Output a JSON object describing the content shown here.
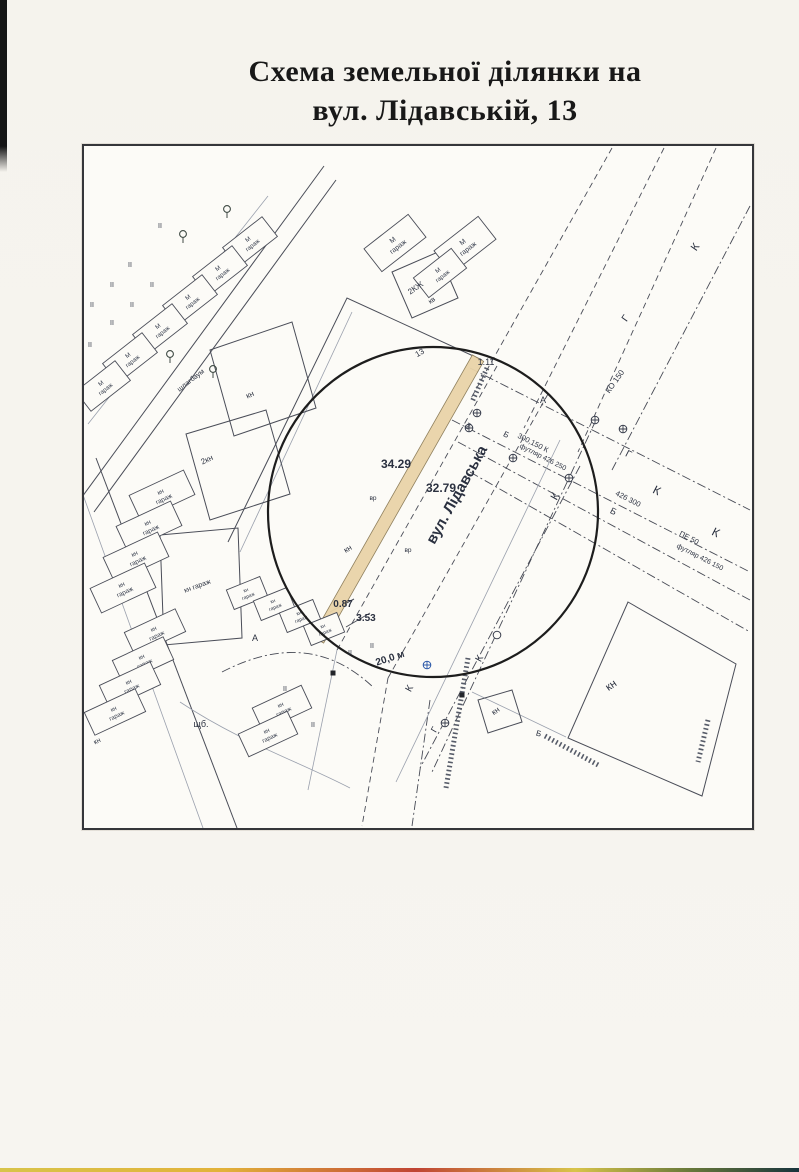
{
  "title": {
    "line1": "Схема земельної ділянки на",
    "line2": "вул. Лідавській, 13"
  },
  "map": {
    "garage_label": "гараж",
    "highlight_fill": "#ead4a9",
    "circle": {
      "cx": 433,
      "cy": 512,
      "r": 165
    },
    "strip": {
      "cx": 398,
      "cy": 499,
      "w": 13,
      "len": 324,
      "r": 29.6
    },
    "lines": [
      {
        "d": "M88,424 L268,196",
        "k": "light"
      },
      {
        "d": "M82,497 L324,166",
        "k": "solid"
      },
      {
        "d": "M94,512 L336,180",
        "k": "solid"
      },
      {
        "d": "M96,458 L237,828",
        "k": "solid"
      },
      {
        "d": "M82,492 L203,828",
        "k": "light"
      },
      {
        "d": "M228,542 L347,298 L482,360",
        "k": "solid"
      },
      {
        "d": "M240,552 L352,312",
        "k": "light"
      },
      {
        "d": "M497,366 L337,650",
        "k": "dash"
      },
      {
        "d": "M548,394 L388,678",
        "k": "dash"
      },
      {
        "d": "M388,678 L362,826",
        "k": "dash"
      },
      {
        "d": "M337,650 L308,790",
        "k": "light"
      },
      {
        "d": "M430,700 L412,826",
        "k": "dashdot"
      },
      {
        "d": "M612,148 L470,400",
        "k": "dash"
      },
      {
        "d": "M664,148 L524,428",
        "k": "dash"
      },
      {
        "d": "M716,148 L578,452",
        "k": "dash"
      },
      {
        "d": "M750,206 L612,470",
        "k": "dashdot"
      },
      {
        "d": "M470,368 L750,510",
        "k": "dashdot"
      },
      {
        "d": "M452,420 L750,572",
        "k": "dashdot"
      },
      {
        "d": "M458,442 L750,600",
        "k": "dashdot"
      },
      {
        "d": "M470,472 L750,632",
        "k": "dashdot"
      },
      {
        "d": "M596,420 L432,772",
        "k": "dashdot"
      },
      {
        "d": "M580,466 L420,768",
        "k": "dashdot"
      },
      {
        "d": "M560,440 L396,782",
        "k": "light"
      },
      {
        "d": "M222,672 C280,642 330,646 374,688",
        "k": "dashdot"
      },
      {
        "d": "M180,702 C240,742 300,762 350,788",
        "k": "light"
      },
      {
        "d": "M472,692 L566,737",
        "k": "light"
      },
      {
        "d": "M468,658 L446,788",
        "k": "hatch"
      },
      {
        "d": "M545,736 L600,766",
        "k": "hatch"
      },
      {
        "d": "M708,720 L698,762",
        "k": "hatch"
      },
      {
        "d": "M487,368 L472,402",
        "k": "hatch"
      },
      {
        "d": "M330,612 L354,599",
        "k": "solid"
      },
      {
        "d": "M346,627 L370,613",
        "k": "solid"
      }
    ],
    "parcels": [
      {
        "pts": "160,535 238,528 242,638 164,645"
      },
      {
        "pts": "628,602 736,664 702,796 568,738"
      },
      {
        "pts": "478,700 512,690 522,722 488,733"
      },
      {
        "pts": "392,272 438,252 458,298 412,318"
      },
      {
        "pts": "210,350 292,322 316,408 234,436"
      },
      {
        "pts": "186,434 266,410 290,494 210,520"
      }
    ],
    "garages": [
      {
        "x": 250,
        "y": 242,
        "w": 50,
        "h": 25,
        "r": -38,
        "p": "М"
      },
      {
        "x": 220,
        "y": 271,
        "w": 50,
        "h": 25,
        "r": -38,
        "p": "М"
      },
      {
        "x": 190,
        "y": 300,
        "w": 50,
        "h": 25,
        "r": -38,
        "p": "М"
      },
      {
        "x": 160,
        "y": 329,
        "w": 50,
        "h": 25,
        "r": -38,
        "p": "М"
      },
      {
        "x": 130,
        "y": 358,
        "w": 50,
        "h": 25,
        "r": -38,
        "p": "М"
      },
      {
        "x": 103,
        "y": 386,
        "w": 50,
        "h": 25,
        "r": -38,
        "p": "М"
      },
      {
        "x": 395,
        "y": 243,
        "w": 56,
        "h": 29,
        "r": -38,
        "p": "М"
      },
      {
        "x": 465,
        "y": 245,
        "w": 56,
        "h": 29,
        "r": -38,
        "p": "М"
      },
      {
        "x": 440,
        "y": 273,
        "w": 48,
        "h": 25,
        "r": -38,
        "p": "М"
      },
      {
        "x": 162,
        "y": 495,
        "w": 60,
        "h": 27,
        "r": -25,
        "p": "кн"
      },
      {
        "x": 149,
        "y": 526,
        "w": 60,
        "h": 27,
        "r": -25,
        "p": "кн"
      },
      {
        "x": 136,
        "y": 557,
        "w": 60,
        "h": 27,
        "r": -25,
        "p": "кн"
      },
      {
        "x": 123,
        "y": 588,
        "w": 60,
        "h": 27,
        "r": -25,
        "p": "кн"
      },
      {
        "x": 155,
        "y": 632,
        "w": 56,
        "h": 25,
        "r": -25,
        "p": "кн"
      },
      {
        "x": 143,
        "y": 660,
        "w": 56,
        "h": 25,
        "r": -25,
        "p": "кн"
      },
      {
        "x": 130,
        "y": 685,
        "w": 56,
        "h": 25,
        "r": -25,
        "p": "кн"
      },
      {
        "x": 115,
        "y": 712,
        "w": 56,
        "h": 25,
        "r": -25,
        "p": "кн"
      },
      {
        "x": 247,
        "y": 593,
        "w": 36,
        "h": 21,
        "r": -22,
        "p": "кн"
      },
      {
        "x": 274,
        "y": 604,
        "w": 36,
        "h": 21,
        "r": -22,
        "p": "кн"
      },
      {
        "x": 300,
        "y": 616,
        "w": 36,
        "h": 21,
        "r": -22,
        "p": "кн"
      },
      {
        "x": 324,
        "y": 629,
        "w": 36,
        "h": 21,
        "r": -22,
        "p": "кн"
      },
      {
        "x": 282,
        "y": 708,
        "w": 54,
        "h": 25,
        "r": -25,
        "p": "кн"
      },
      {
        "x": 268,
        "y": 734,
        "w": 54,
        "h": 25,
        "r": -25,
        "p": "кн"
      }
    ],
    "trees": [
      [
        227,
        213
      ],
      [
        183,
        238
      ],
      [
        170,
        358
      ],
      [
        213,
        373
      ]
    ],
    "manholes": [
      [
        477,
        413,
        "c"
      ],
      [
        469,
        428,
        "c"
      ],
      [
        513,
        458,
        "c"
      ],
      [
        569,
        478,
        "c"
      ],
      [
        595,
        420,
        "c"
      ],
      [
        623,
        429,
        "c"
      ],
      [
        445,
        723,
        "c"
      ],
      [
        427,
        665,
        "b"
      ],
      [
        497,
        635,
        "p"
      ]
    ],
    "squares": [
      [
        333,
        673
      ],
      [
        462,
        695
      ]
    ],
    "labels": [
      {
        "n": "street-name",
        "t": "вул. Лідавська",
        "x": 461,
        "y": 497,
        "r": -61,
        "s": 15,
        "b": 1
      },
      {
        "n": "dim-west",
        "t": "34.29",
        "x": 396,
        "y": 468,
        "r": 0,
        "s": 12,
        "b": 1
      },
      {
        "n": "dim-east",
        "t": "32.79",
        "x": 441,
        "y": 492,
        "r": 0,
        "s": 12,
        "b": 1
      },
      {
        "n": "dim-offset-1",
        "t": "0.87",
        "x": 343,
        "y": 607,
        "r": 0,
        "s": 10,
        "b": 1
      },
      {
        "n": "dim-offset-2",
        "t": "3.53",
        "x": 366,
        "y": 621,
        "r": 0,
        "s": 10,
        "b": 1
      },
      {
        "n": "dim-north",
        "t": "1.11",
        "x": 486,
        "y": 365,
        "r": 0,
        "s": 9
      },
      {
        "n": "road-width",
        "t": "20,0 м",
        "x": 391,
        "y": 661,
        "r": -18,
        "s": 10,
        "b": 1
      },
      {
        "n": "plot-number",
        "t": "13",
        "x": 421,
        "y": 355,
        "r": -30,
        "s": 8
      },
      {
        "n": "parcel-2kn",
        "t": "2кн",
        "x": 208,
        "y": 462,
        "r": -25,
        "s": 8
      },
      {
        "n": "parcel-kn-a",
        "t": "кн",
        "x": 251,
        "y": 397,
        "r": -25,
        "s": 8
      },
      {
        "n": "parcel-kn-b",
        "t": "кн",
        "x": 349,
        "y": 551,
        "r": -30,
        "s": 8
      },
      {
        "n": "parcel-kn-c",
        "t": "кн",
        "x": 613,
        "y": 688,
        "r": -35,
        "s": 11
      },
      {
        "n": "parcel-kn-d",
        "t": "кн",
        "x": 497,
        "y": 713,
        "r": -35,
        "s": 8
      },
      {
        "n": "parcel-kn-e",
        "t": "кн",
        "x": 98,
        "y": 743,
        "r": -25,
        "s": 7
      },
      {
        "n": "building-2kzh",
        "t": "2КЖ",
        "x": 417,
        "y": 290,
        "r": -35,
        "s": 8
      },
      {
        "n": "building-kv",
        "t": "кв",
        "x": 433,
        "y": 302,
        "r": -35,
        "s": 7
      },
      {
        "n": "big-garage-parcel",
        "t": "кн гараж",
        "x": 198,
        "y": 588,
        "r": -20,
        "s": 7
      },
      {
        "n": "barrier-label",
        "t": "шлагбаум",
        "x": 192,
        "y": 382,
        "r": -38,
        "s": 7
      },
      {
        "n": "road-surface",
        "t": "щб.",
        "x": 201,
        "y": 727,
        "r": 0,
        "s": 9
      },
      {
        "n": "zone-a-1",
        "t": "А",
        "x": 543,
        "y": 403,
        "r": 0,
        "s": 9
      },
      {
        "n": "zone-a-2",
        "t": "А",
        "x": 255,
        "y": 641,
        "r": 0,
        "s": 9
      },
      {
        "n": "util-b-1",
        "t": "Б",
        "x": 612,
        "y": 514,
        "r": 27,
        "s": 9
      },
      {
        "n": "util-b-2",
        "t": "Б",
        "x": 538,
        "y": 736,
        "r": 15,
        "s": 8
      },
      {
        "n": "util-b-3",
        "t": "Б",
        "x": 505,
        "y": 437,
        "r": 27,
        "s": 8
      },
      {
        "n": "util-g-1",
        "t": "Г",
        "x": 627,
        "y": 457,
        "r": 27,
        "s": 10
      },
      {
        "n": "util-g-2",
        "t": "Г",
        "x": 628,
        "y": 320,
        "r": -55,
        "s": 10
      },
      {
        "n": "util-g-3",
        "t": "Г",
        "x": 437,
        "y": 731,
        "r": -60,
        "s": 9
      },
      {
        "n": "util-k-1",
        "t": "К",
        "x": 558,
        "y": 498,
        "r": -61,
        "s": 11
      },
      {
        "n": "util-k-2",
        "t": "К",
        "x": 482,
        "y": 660,
        "r": -61,
        "s": 10
      },
      {
        "n": "util-k-3",
        "t": "К",
        "x": 412,
        "y": 690,
        "r": -61,
        "s": 10
      },
      {
        "n": "util-k-4",
        "t": "К",
        "x": 698,
        "y": 249,
        "r": -55,
        "s": 11
      },
      {
        "n": "util-k-5",
        "t": "К",
        "x": 655,
        "y": 494,
        "r": 27,
        "s": 12
      },
      {
        "n": "util-k-6",
        "t": "К",
        "x": 714,
        "y": 536,
        "r": 27,
        "s": 12
      },
      {
        "n": "pipe-spec-1a",
        "t": "300,150 К",
        "x": 532,
        "y": 445,
        "r": 27,
        "s": 7.5
      },
      {
        "n": "pipe-spec-1b",
        "t": "футляр 426 250",
        "x": 542,
        "y": 459,
        "r": 27,
        "s": 7
      },
      {
        "n": "pipe-spec-2",
        "t": "426 300",
        "x": 627,
        "y": 501,
        "r": 27,
        "s": 7.5
      },
      {
        "n": "pipe-spec-3a",
        "t": "ПЕ 50",
        "x": 688,
        "y": 540,
        "r": 27,
        "s": 7.5
      },
      {
        "n": "pipe-spec-3b",
        "t": "футляр 426 150",
        "x": 699,
        "y": 559,
        "r": 27,
        "s": 7
      },
      {
        "n": "pipe-spec-4",
        "t": "КО 150",
        "x": 617,
        "y": 383,
        "r": -55,
        "s": 8
      },
      {
        "n": "point-vr-1",
        "t": "вр",
        "x": 373,
        "y": 500,
        "r": 0,
        "s": 6.5
      },
      {
        "n": "point-vr-2",
        "t": "вр",
        "x": 408,
        "y": 552,
        "r": 0,
        "s": 6.5
      },
      {
        "n": "point-bp",
        "t": "бп",
        "x": 470,
        "y": 427,
        "r": -61,
        "s": 6.5
      },
      {
        "n": "mark-ii",
        "t": "II",
        "x": 160,
        "y": 228,
        "r": 0,
        "s": 7
      },
      {
        "n": "mark-ii",
        "t": "II",
        "x": 130,
        "y": 267,
        "r": 0,
        "s": 7
      },
      {
        "n": "mark-ii",
        "t": "II",
        "x": 112,
        "y": 287,
        "r": 0,
        "s": 7
      },
      {
        "n": "mark-ii",
        "t": "II",
        "x": 152,
        "y": 287,
        "r": 0,
        "s": 7
      },
      {
        "n": "mark-ii",
        "t": "II",
        "x": 92,
        "y": 307,
        "r": 0,
        "s": 7
      },
      {
        "n": "mark-ii",
        "t": "II",
        "x": 132,
        "y": 307,
        "r": 0,
        "s": 7
      },
      {
        "n": "mark-ii",
        "t": "II",
        "x": 112,
        "y": 325,
        "r": 0,
        "s": 7
      },
      {
        "n": "mark-ii",
        "t": "II",
        "x": 90,
        "y": 347,
        "r": 0,
        "s": 7
      },
      {
        "n": "mark-ii",
        "t": "II",
        "x": 285,
        "y": 691,
        "r": 0,
        "s": 7
      },
      {
        "n": "mark-ii",
        "t": "II",
        "x": 313,
        "y": 727,
        "r": 0,
        "s": 7
      },
      {
        "n": "mark-ii",
        "t": "II",
        "x": 350,
        "y": 655,
        "r": 0,
        "s": 7
      },
      {
        "n": "mark-ii",
        "t": "II",
        "x": 372,
        "y": 648,
        "r": 0,
        "s": 7
      }
    ]
  }
}
